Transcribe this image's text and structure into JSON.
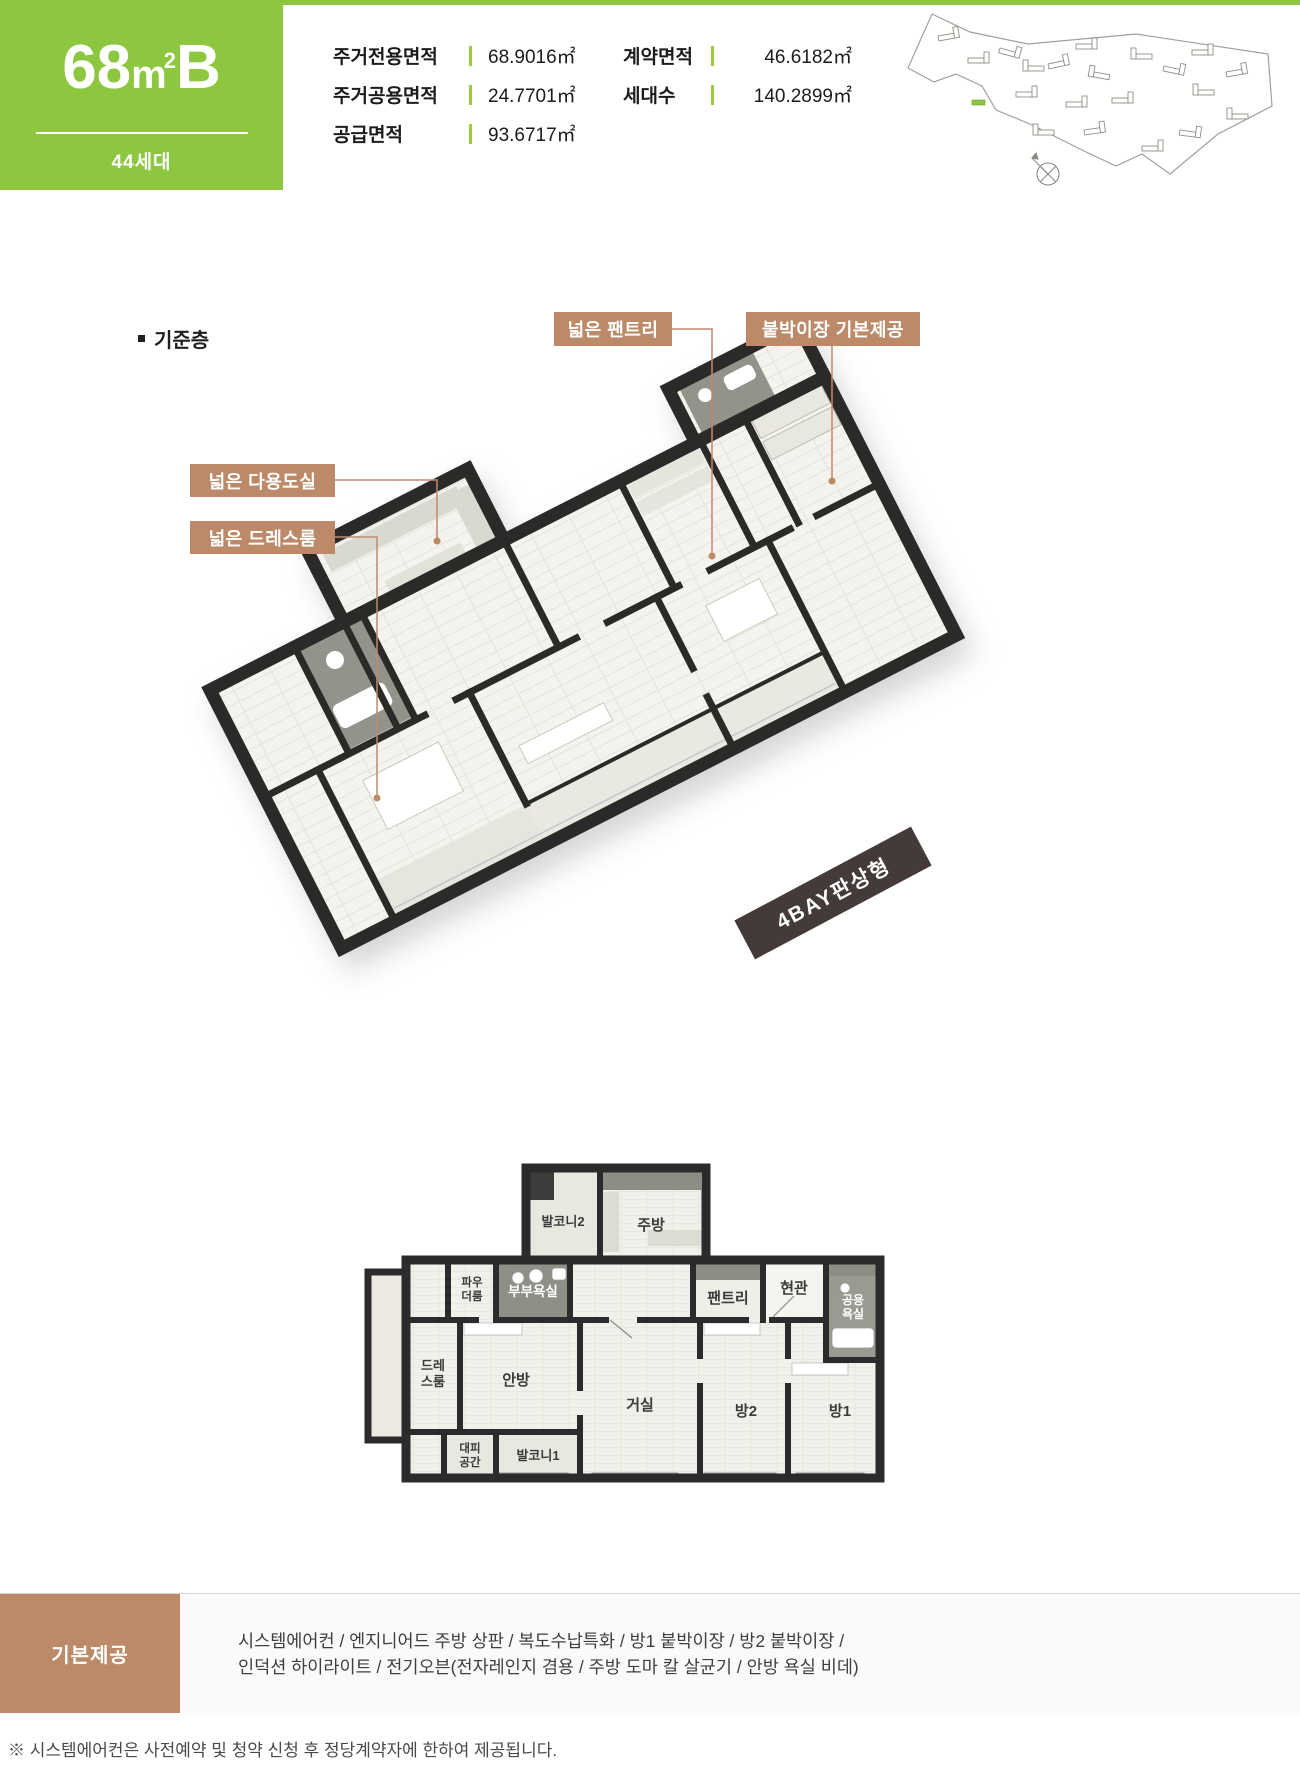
{
  "header": {
    "unit": {
      "num": "68",
      "meter": "m",
      "sup": "2",
      "letter": "B"
    },
    "households": "44세대",
    "specs_left": [
      {
        "label": "주거전용면적",
        "value": "68.9016㎡"
      },
      {
        "label": "주거공용면적",
        "value": "24.7701㎡"
      },
      {
        "label": "공급면적",
        "value": "93.6717㎡"
      }
    ],
    "specs_right": [
      {
        "label": "계약면적",
        "value": "46.6182㎡"
      },
      {
        "label": "세대수",
        "value": "140.2899㎡"
      }
    ]
  },
  "colors": {
    "accent_green": "#8dc63f",
    "callout_brown": "#bc8a68",
    "ribbon_dark": "#453a3a",
    "wall_black": "#2b2a28"
  },
  "floor_section": {
    "section_title": "기준층",
    "callouts": {
      "pantry": "넓은 팬트리",
      "wardrobe": "붙박이장 기본제공",
      "utility": "넓은 다용도실",
      "dressroom": "넓은 드레스룸"
    },
    "ribbon": "4BAY판상형"
  },
  "plan2d": {
    "rooms": {
      "balcony2": "발코니2",
      "kitchen": "주방",
      "powder1": "파우",
      "powder2": "더룸",
      "master_bath": "부부욕실",
      "pantry": "팬트리",
      "entrance": "현관",
      "common_bath1": "공용",
      "common_bath2": "욕실",
      "dress1": "드레",
      "dress2": "스룸",
      "master": "안방",
      "living": "거실",
      "room2": "방2",
      "room1": "방1",
      "evac1": "대피",
      "evac2": "공간",
      "balcony1": "발코니1"
    }
  },
  "provide": {
    "title": "기본제공",
    "line1": "시스템에어컨 / 엔지니어드 주방 상판 / 복도수납특화 / 방1 붙박이장 / 방2 붙박이장 /",
    "line2": "인덕션 하이라이트 / 전기오븐(전자레인지 겸용 / 주방 도마 칼 살균기 / 안방 욕실 비데)"
  },
  "footnote": "※ 시스템에어컨은 사전예약 및 청약 신청 후 정당계약자에 한하여 제공됩니다."
}
